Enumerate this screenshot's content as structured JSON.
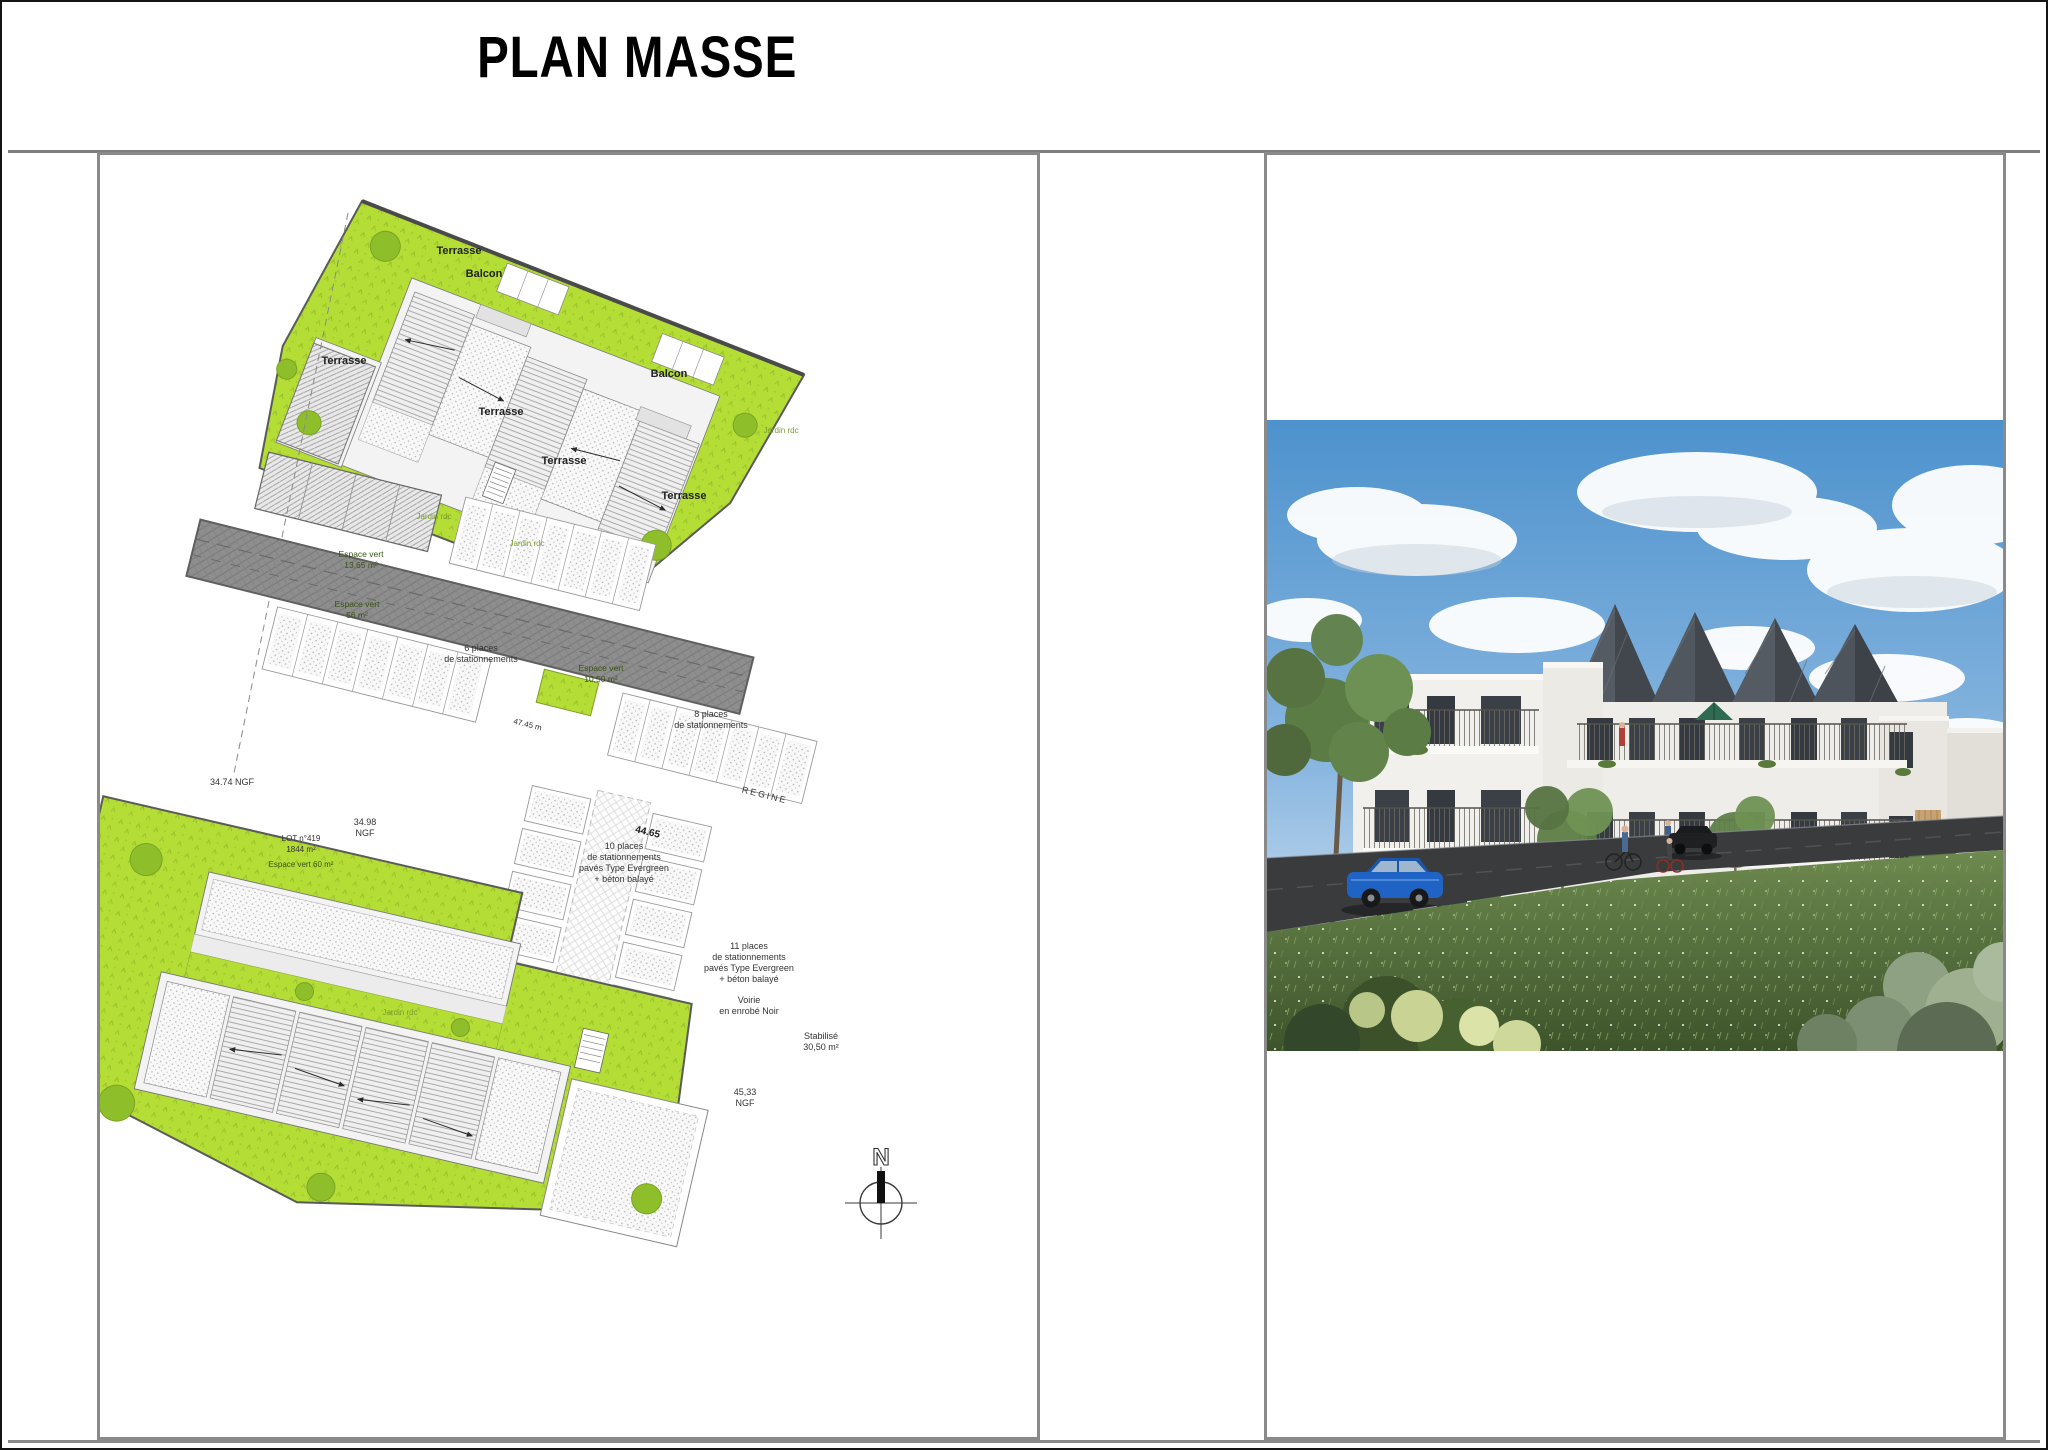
{
  "title": "PLAN MASSE",
  "colors": {
    "site_green": "#b4dd36",
    "tree_green": "#8fbe2b",
    "road_gray": "#8e8e8e",
    "roof_slate": "#42474d",
    "sky_blue": "#4d92cd",
    "car_blue": "#1f63c4",
    "meadow_green": "#4a6434",
    "panel_border": "#8a8a8a"
  },
  "plan": {
    "labels": {
      "terrasse": "Terrasse",
      "balcon": "Balcon",
      "jardin_rdc": "Jardin rdc",
      "esp1365a": "Espace vert",
      "esp1365b": "13,65 m²",
      "esp56a": "Espace vert",
      "esp56b": "56 m²",
      "esp1050a": "Espace vert",
      "esp1050b": "10,50 m²",
      "lot1": "LOT n°419",
      "lot2": "1844 m²",
      "lot3": "Espace vert 60 m²",
      "p6a": "6 places",
      "p6b": "de stationnements",
      "p8a": "8 places",
      "p8b": "de stationnements",
      "p10a": "10 places",
      "p10b": "de stationnements",
      "p10c": "pavés Type Evergreen",
      "p10d": "+ béton balayé",
      "p11a": "11 places",
      "p11b": "de stationnements",
      "p11c": "pavés Type Evergreen",
      "p11d": "+ béton balayé",
      "voiriea": "Voirie",
      "voirieb": "en enrobé Noir",
      "staba": "Stabilisé",
      "stabb": "30,50 m²",
      "ngf3474": "34.74 NGF",
      "ngf3498a": "34.98",
      "ngf3498b": "NGF",
      "ngf4533a": "45,33",
      "ngf4533b": "NGF",
      "dim4465": "44.65",
      "dim4745": "47.45 m",
      "road_name": "REGINE",
      "north": "N"
    }
  }
}
